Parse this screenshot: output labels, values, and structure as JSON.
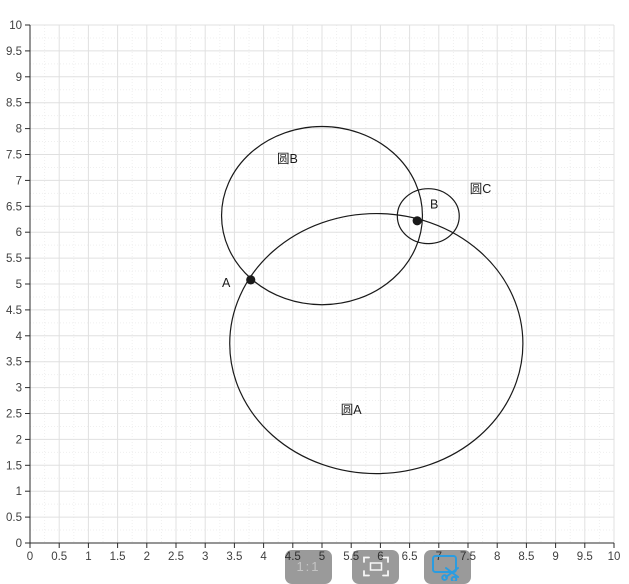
{
  "chart_data": {
    "type": "scatter",
    "title": "",
    "description": "Geometry plot of three intersecting circles (circle A, circle B, circle C) with intersection points A and B marked on a 0-10 grid",
    "x_axis": {
      "min": 0,
      "max": 10,
      "tick_step": 0.5,
      "tick_labels": [
        "0",
        "0.5",
        "1",
        "1.5",
        "2",
        "2.5",
        "3",
        "3.5",
        "4",
        "4.5",
        "5",
        "5.5",
        "6",
        "6.5",
        "7",
        "7.5",
        "8",
        "8.5",
        "9",
        "9.5",
        "10"
      ]
    },
    "y_axis": {
      "min": 0,
      "max": 10,
      "tick_step": 0.5,
      "tick_labels": [
        "0",
        "0.5",
        "1",
        "1.5",
        "2",
        "2.5",
        "3",
        "3.5",
        "4",
        "4.5",
        "5",
        "5.5",
        "6",
        "6.5",
        "7",
        "7.5",
        "8",
        "8.5",
        "9",
        "9.5",
        "10"
      ]
    },
    "grid": {
      "major": true,
      "minor": true,
      "minor_step": 0.25
    },
    "circles": [
      {
        "name": "circle-A",
        "label": "圆A",
        "center": [
          5.93,
          3.85
        ],
        "radius": 2.51,
        "label_pos": [
          5.32,
          2.49
        ],
        "label_anchor": "start"
      },
      {
        "name": "circle-B",
        "label": "圆B",
        "center": [
          5.0,
          6.32
        ],
        "radius": 1.72,
        "label_pos": [
          4.23,
          7.34
        ],
        "label_anchor": "start"
      },
      {
        "name": "circle-C",
        "label": "圆C",
        "center": [
          6.82,
          6.31
        ],
        "radius": 0.53,
        "label_pos": [
          7.53,
          6.76
        ],
        "label_anchor": "start"
      }
    ],
    "points": [
      {
        "name": "point-A",
        "label": "A",
        "coords": [
          3.78,
          5.08
        ],
        "label_pos": [
          3.36,
          5.02
        ],
        "label_anchor": "middle"
      },
      {
        "name": "point-B",
        "label": "B",
        "coords": [
          6.63,
          6.22
        ],
        "label_pos": [
          6.92,
          6.53
        ],
        "label_anchor": "middle"
      }
    ],
    "colors": {
      "axis": "#2b2b2b",
      "grid_major": "#e0e0e0",
      "grid_minor": "#efefef",
      "curve": "#1a1a1a",
      "tick_text": "#404040",
      "label_text": "#1a1a1a"
    },
    "legend": null
  },
  "toolbar": {
    "buttons": [
      {
        "name": "actual-size-button",
        "icon": "one-to-one-icon",
        "label": "1:1"
      },
      {
        "name": "frame-capture-button",
        "icon": "frame-select-icon",
        "label": ""
      },
      {
        "name": "crop-screenshot-button",
        "icon": "crop-scissors-icon",
        "label": "",
        "accent": "#2b9ce0"
      }
    ]
  }
}
